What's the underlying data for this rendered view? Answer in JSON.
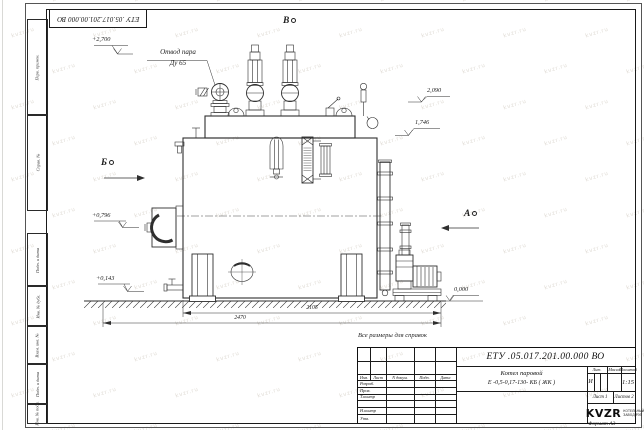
{
  "sheet": {
    "watermark_text": "kvzr.ru",
    "doc_number_top": "ЕТУ .05.017.201.00.000  ВО",
    "reference_note": "Все размеры для справок",
    "format_note": "Формат А3"
  },
  "margin_labels": {
    "perv_primen": "Перв. примен.",
    "sprav_no": "Справ. №",
    "podp_data_1": "Подп. и дата",
    "inv_dubl": "Инв. № дубл.",
    "vzam_inv": "Взам. инв. №",
    "podp_data_2": "Подп. и дата",
    "inv_podl": "Инв. № подл."
  },
  "annotations": {
    "steam_outlet_line1": "Отвод пара",
    "steam_outlet_line2": "Ду 65",
    "view_a": "А",
    "view_b": "Б",
    "view_v": "В"
  },
  "elevations": {
    "top": "+2,700",
    "stack": "2,090",
    "drum": "1,746",
    "burner": "+0,796",
    "base": "+0,143",
    "ground": "0,000"
  },
  "dimensions": {
    "body_length": "2105",
    "overall_length": "2470"
  },
  "title_block": {
    "doc_number": "ЕТУ .05.017.201.00.000  ВО",
    "product_line1": "Котел паровой",
    "product_line2": "Е -0,5-0,17-130- КБ ( ЖК )",
    "col_izm": "Изм.",
    "col_list": "Лист",
    "col_doc": "N докум.",
    "col_podp": "Подп.",
    "col_data": "Дата",
    "role_razrab": "Разраб.",
    "role_prov": "Пров.",
    "role_tkontr": "Т.контр",
    "role_nkontr": "Н.контр",
    "role_utv": "Утв.",
    "lit_header": "Лит.",
    "mass_header": "Масса",
    "scale_header": "Масштаб",
    "lit_value": "И",
    "scale_value": "1:15",
    "sheet_info": "Лист 1",
    "sheets_info": "Листов 2",
    "logo_text": "KVZR",
    "logo_tagline1": "КОТЕЛЬНЫЙ",
    "logo_tagline2": "ЗАВОД РЭП"
  }
}
